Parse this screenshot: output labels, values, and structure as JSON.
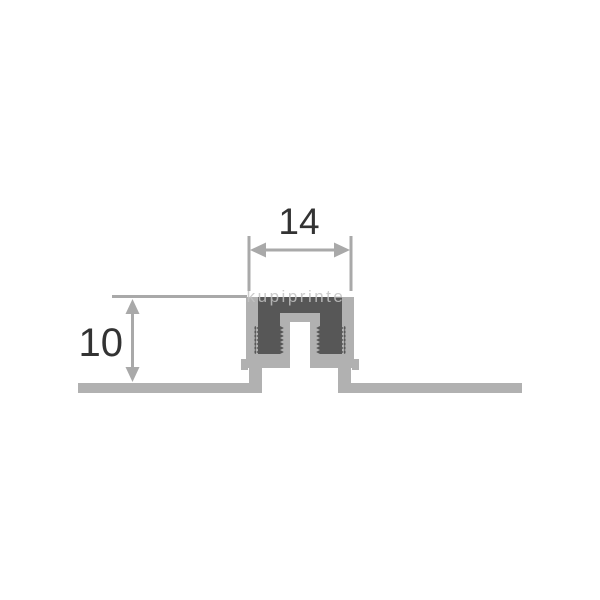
{
  "watermark": {
    "text": "kupiprinte"
  },
  "diagram": {
    "dimensions": {
      "width_label": "14",
      "height_label": "10"
    },
    "colors": {
      "background": "#ffffff",
      "profile_gray": "#b1b1b1",
      "insert_dark": "#575757",
      "dim_gray": "#a9a9a9",
      "text_dark": "#333333"
    }
  }
}
